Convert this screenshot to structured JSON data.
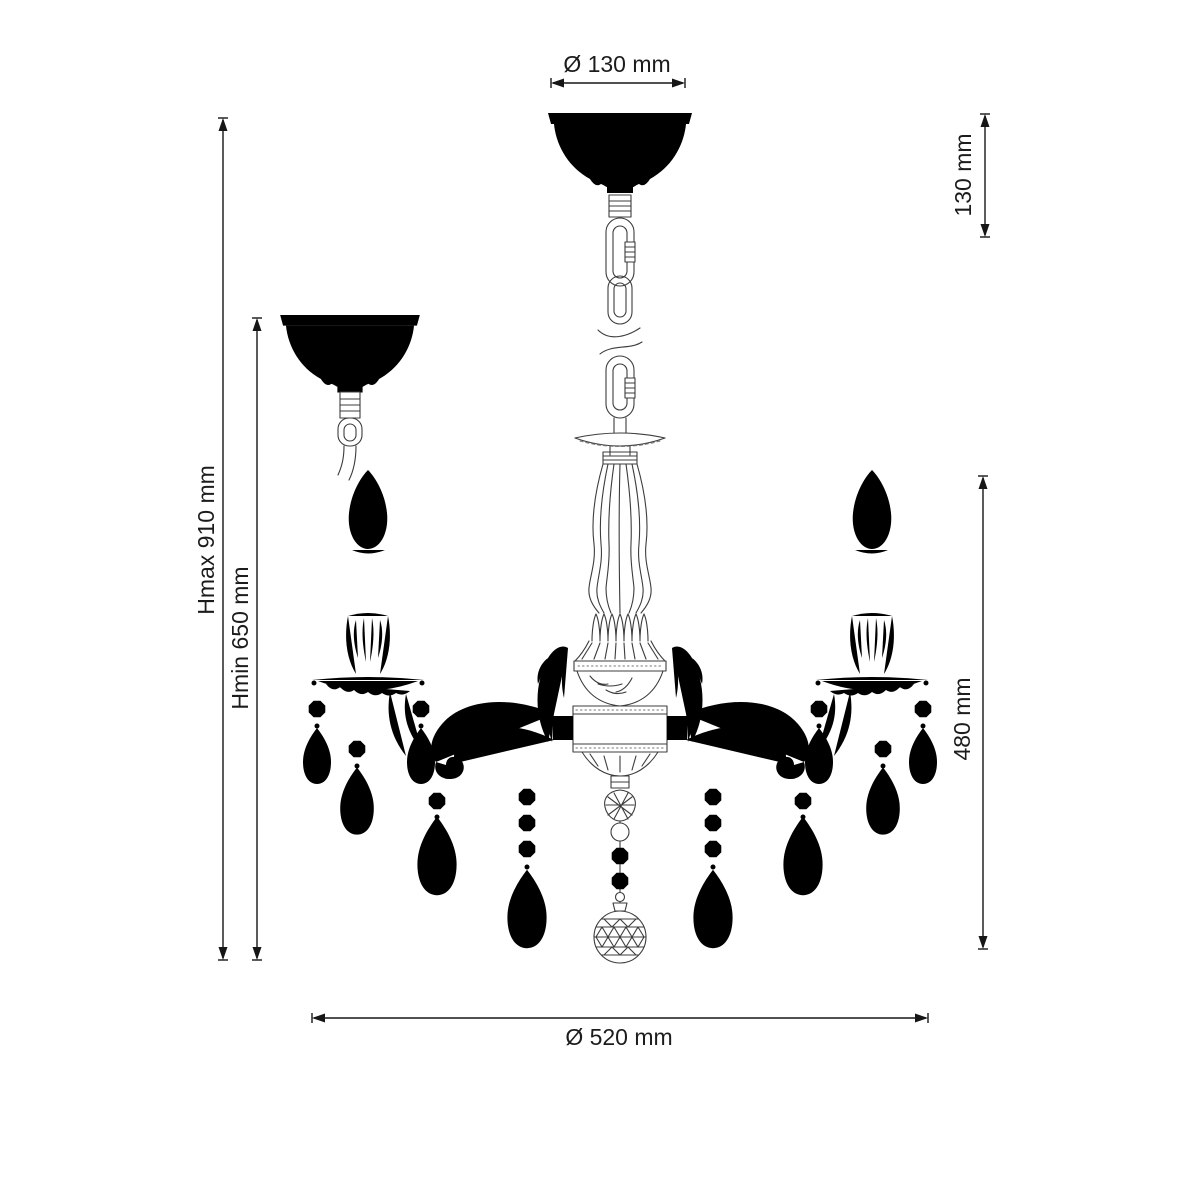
{
  "drawing": {
    "subject": "3-arm crystal chandelier technical dimension drawing",
    "background_color": "#ffffff",
    "line_color": "#3c3c3c",
    "dimension_color": "#161616",
    "labels": {
      "top_diameter": "Ø 130 mm",
      "canopy_height": "130 mm",
      "height_max": "Hmax 910 mm",
      "height_min": "Hmin 650 mm",
      "fixture_height": "480 mm",
      "fixture_diameter": "Ø 520 mm"
    },
    "values_mm": {
      "canopy_diameter": 130,
      "canopy_height": 130,
      "height_max": 910,
      "height_min": 650,
      "fixture_height": 480,
      "fixture_diameter": 520
    }
  }
}
